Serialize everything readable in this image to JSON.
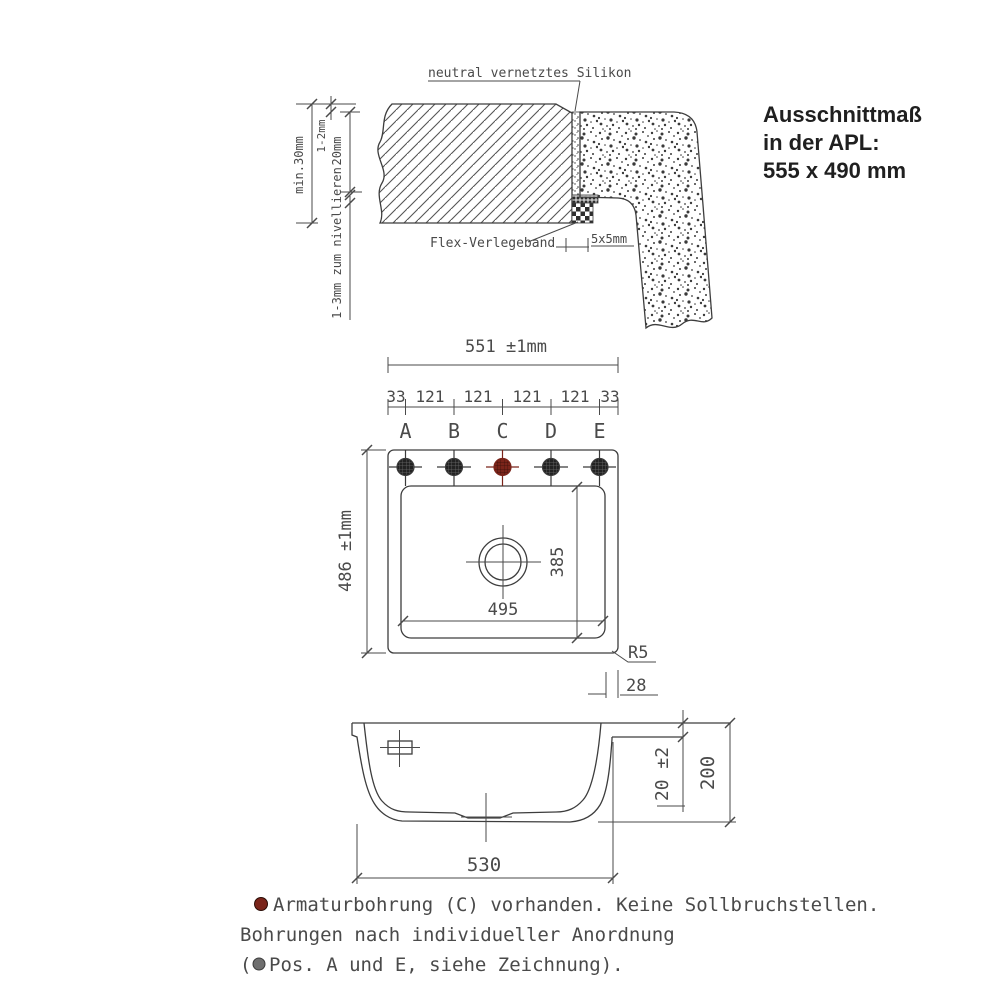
{
  "cutout_note": {
    "line1": "Ausschnittmaß",
    "line2": "in der APL:",
    "line3": "555 x 490 mm"
  },
  "section_detail": {
    "silicone_label": "neutral vernetztes Silikon",
    "flex_tape_label": "Flex-Verlegeband",
    "dim_5x5": "5x5mm",
    "dim_min_thickness": "min.30mm",
    "dim_joint": "1-2mm",
    "dim_rim_height": "20mm",
    "dim_levelling": "1-3mm zum nivellieren"
  },
  "top_view": {
    "dim_overall_width": "551 ±1mm",
    "segments": [
      "33",
      "121",
      "121",
      "121",
      "121",
      "33"
    ],
    "hole_labels": [
      "A",
      "B",
      "C",
      "D",
      "E"
    ],
    "dim_overall_depth": "486 ±1mm",
    "dim_basin_width": "495",
    "dim_basin_depth": "385",
    "corner_radius": "R5",
    "dim_rim_offset": "28",
    "hole_color": "#3a3a3a",
    "fitting_hole_color": "#7a241a"
  },
  "side_view": {
    "dim_bottom_width": "530",
    "dim_rim_thickness": "20 ±2",
    "dim_total_depth": "200"
  },
  "footnote": {
    "bullet1_color": "#7a241a",
    "line1": "Armaturbohrung (C) vorhanden. Keine Sollbruchstellen.",
    "line2": "Bohrungen nach individueller Anordnung",
    "line3_prefix": "(",
    "bullet2_color": "#6f6f6f",
    "line3": "Pos. A und E, siehe Zeichnung)."
  }
}
